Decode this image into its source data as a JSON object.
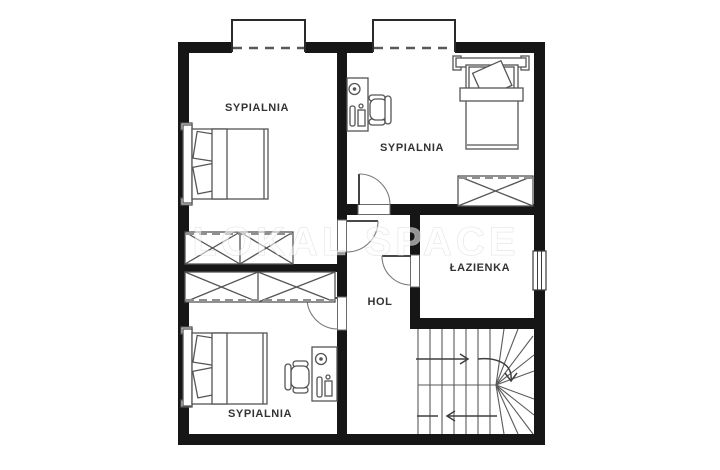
{
  "plan": {
    "rooms": [
      {
        "name": "bedroom-top-left",
        "label": "SYPIALNIA"
      },
      {
        "name": "bedroom-top-right",
        "label": "SYPIALNIA"
      },
      {
        "name": "bathroom",
        "label": "ŁAZIENKA"
      },
      {
        "name": "hall",
        "label": "HOL"
      },
      {
        "name": "bedroom-bottom",
        "label": "SYPIALNIA"
      }
    ],
    "watermark": "LOKAL SPACE",
    "furniture_icons": [
      "double-bed",
      "single-bed",
      "wardrobe",
      "desk",
      "office-chair",
      "stairs",
      "door-swing",
      "window",
      "dormer-window"
    ],
    "colors": {
      "wall": "#161616",
      "furniture_stroke": "#555555",
      "label_text": "#333333",
      "background": "#ffffff",
      "watermark": "#e9e9e9"
    }
  }
}
